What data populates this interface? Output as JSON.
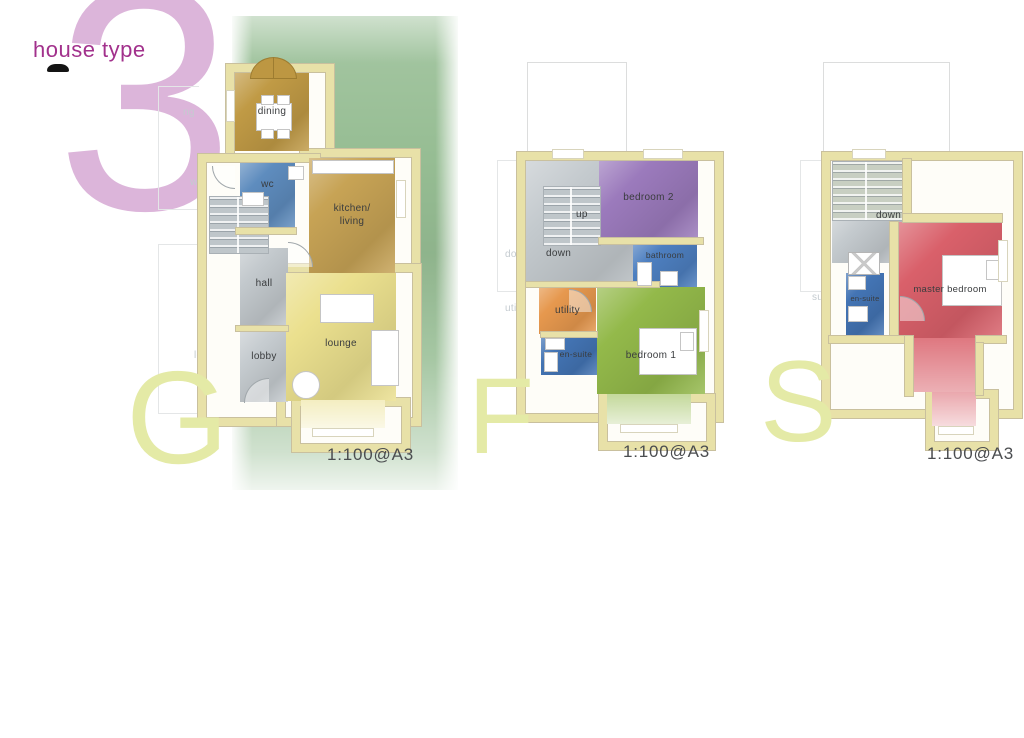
{
  "header": {
    "title": "house type",
    "number": "3"
  },
  "plans": [
    {
      "name": "ground-floor",
      "letter": "G",
      "scale": "1:100@A3",
      "rooms": {
        "dining": "dining",
        "wc": "wc",
        "kitchen_line1": "kitchen/",
        "kitchen_line2": "living",
        "hall": "hall",
        "lobby": "lobby",
        "lounge": "lounge"
      },
      "ghost_labels": {
        "dining": "ng",
        "wc": "wc",
        "hall": "hall",
        "lobby": "lobby"
      }
    },
    {
      "name": "first-floor",
      "letter": "F",
      "scale": "1:100@A3",
      "rooms": {
        "up": "up",
        "down": "down",
        "bedroom2": "bedroom 2",
        "bathroom": "bathroom",
        "utility": "utility",
        "ensuite": "en-suite",
        "bedroom1": "bedroom 1"
      },
      "ghost_labels": {
        "down": "down",
        "utility": "utility"
      }
    },
    {
      "name": "second-floor",
      "letter": "S",
      "scale": "1:100@A3",
      "rooms": {
        "down": "down",
        "master_bedroom": "master bedroom",
        "ensuite": "en-suite"
      },
      "ghost_labels": {
        "ensuite": "suite"
      }
    }
  ],
  "colors": {
    "title": "#a2318c",
    "number": "#dcb5da",
    "floor_letter": "#e4eaa6",
    "garden_green": "#96bd93",
    "wall": "#e8e1a8",
    "dining": "#c09a45",
    "kitchen_living": "#c7a355",
    "wc": "#5e8cbe",
    "hall": "#c3c9cd",
    "lobby": "#c6ccd0",
    "lounge": "#ebe08e",
    "stairs": "#bfc6ca",
    "stairs_second": "#c8cfc2",
    "bedroom2": "#9b7abc",
    "bathroom": "#4d7fc0",
    "utility": "#e6984e",
    "ensuite": "#4374b4",
    "bedroom1": "#93b94a",
    "master_bedroom": "#d9606a"
  }
}
